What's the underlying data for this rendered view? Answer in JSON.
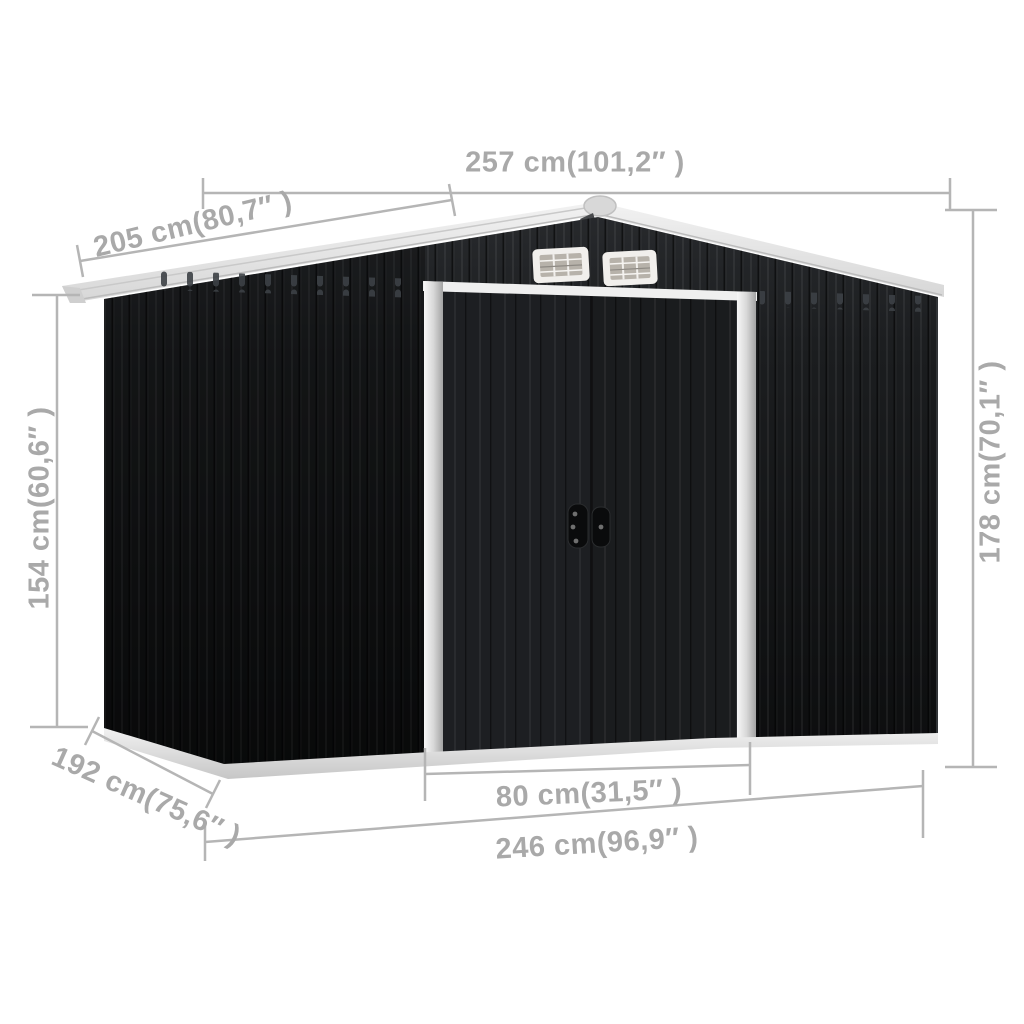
{
  "diagram_type": "product-dimension-diagram",
  "subject": "metal-garden-storage-shed",
  "colors": {
    "background": "#ffffff",
    "shed_body": "#17191b",
    "roof": "#e7e7e7",
    "trim_silver": "#d9d9d9",
    "base": "#dedede",
    "dimension_lines": "#b5b5b5",
    "dimension_text": "#a9a9a9"
  },
  "dimensions": {
    "roof_width": {
      "label": "257 cm(101,2″ )",
      "cm": 257,
      "inch": "101,2"
    },
    "roof_depth": {
      "label": "205 cm(80,7″ )",
      "cm": 205,
      "inch": "80,7"
    },
    "wall_height": {
      "label": "154 cm(60,6″ )",
      "cm": 154,
      "inch": "60,6"
    },
    "total_height": {
      "label": "178 cm(70,1″ )",
      "cm": 178,
      "inch": "70,1"
    },
    "base_depth": {
      "label": "192 cm(75,6″ )",
      "cm": 192,
      "inch": "75,6"
    },
    "door_width": {
      "label": "80 cm(31,5″ )",
      "cm": 80,
      "inch": "31,5"
    },
    "base_width": {
      "label": "246 cm(96,9″ )",
      "cm": 246,
      "inch": "96,9"
    }
  }
}
